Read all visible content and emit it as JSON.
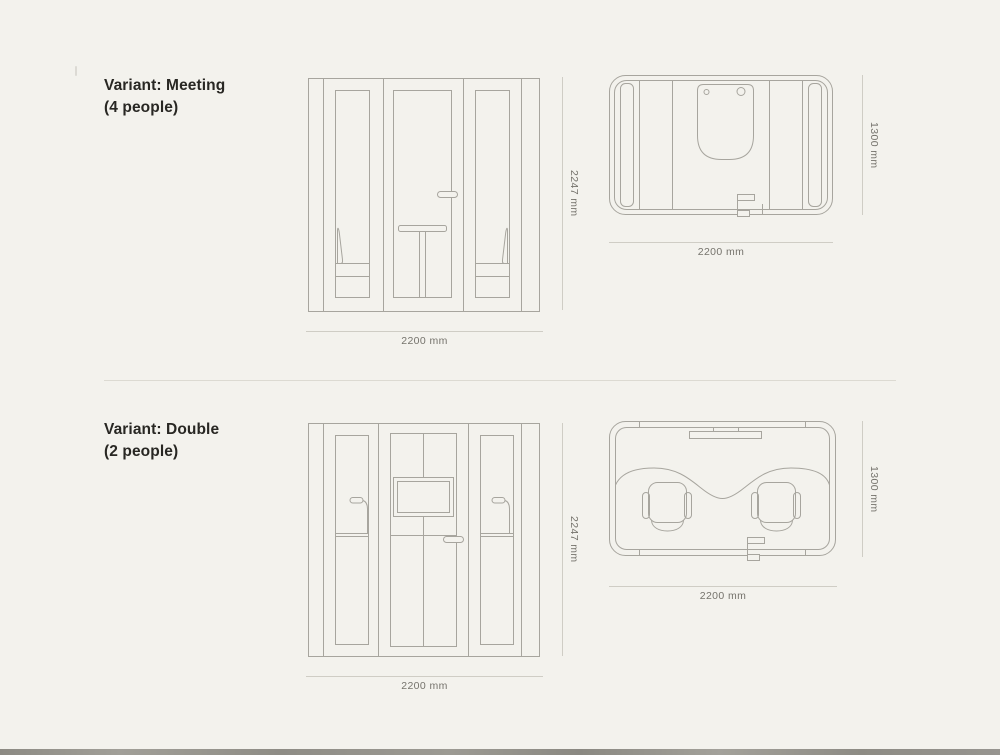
{
  "page": {
    "background": "#f3f2ed",
    "drawing_line_color": "#a7a59e",
    "dimension_line_color": "#cfcdc5",
    "dimension_text_color": "#75736c",
    "heading_color": "#282723"
  },
  "sections": [
    {
      "id": "meeting",
      "title_line1": "Variant: Meeting",
      "title_line2": "(4 people)",
      "front_view": {
        "height_label": "2247 mm",
        "width_label": "2200 mm"
      },
      "top_view": {
        "depth_label": "1300 mm",
        "width_label": "2200 mm"
      }
    },
    {
      "id": "double",
      "title_line1": "Variant: Double",
      "title_line2": "(2 people)",
      "front_view": {
        "height_label": "2247 mm",
        "width_label": "2200 mm"
      },
      "top_view": {
        "depth_label": "1300 mm",
        "width_label": "2200 mm"
      }
    }
  ]
}
